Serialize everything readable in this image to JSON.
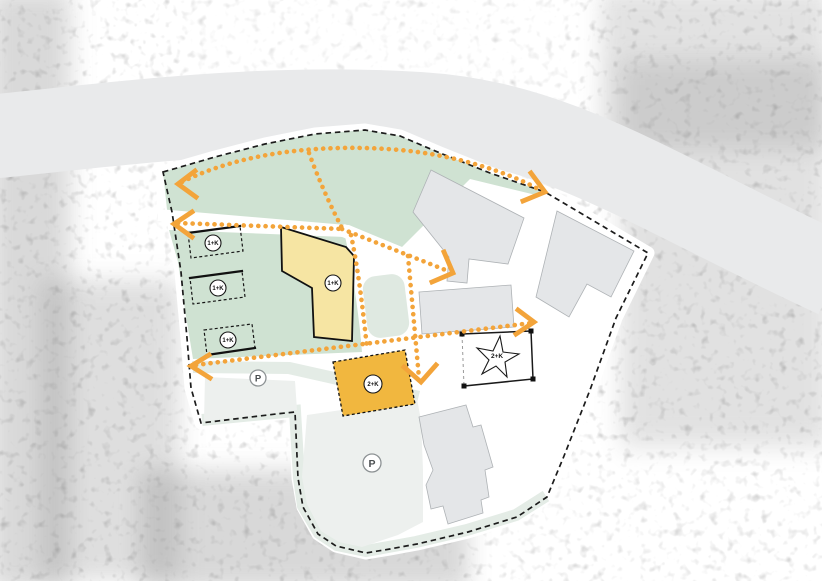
{
  "colors": {
    "green_area": "#cfe2d2",
    "pale_green": "#e4ece6",
    "pond_green": "#dfe9e1",
    "proposed_yellow": "#f6e5a3",
    "proposed_orange": "#f1b73f",
    "route_orange": "#f3a43a",
    "existing_gray": "#e4e6e8",
    "existing_gray_stroke": "#aeb2b5",
    "road_band_gray": "#e9eaeb",
    "parking_gray": "#edf0ee",
    "boundary_black": "#1c1c1c",
    "site_white": "#ffffff"
  },
  "labels": {
    "building_small_1": "1+K",
    "building_small_2": "1+K",
    "building_small_3": "1+K",
    "building_l": "1+K",
    "building_orange": "2+K",
    "star_plot": "2+K",
    "parking_1": "P",
    "parking_2": "P"
  },
  "icons": {
    "star": "star-outline",
    "parking": "letter-P-in-circle"
  }
}
